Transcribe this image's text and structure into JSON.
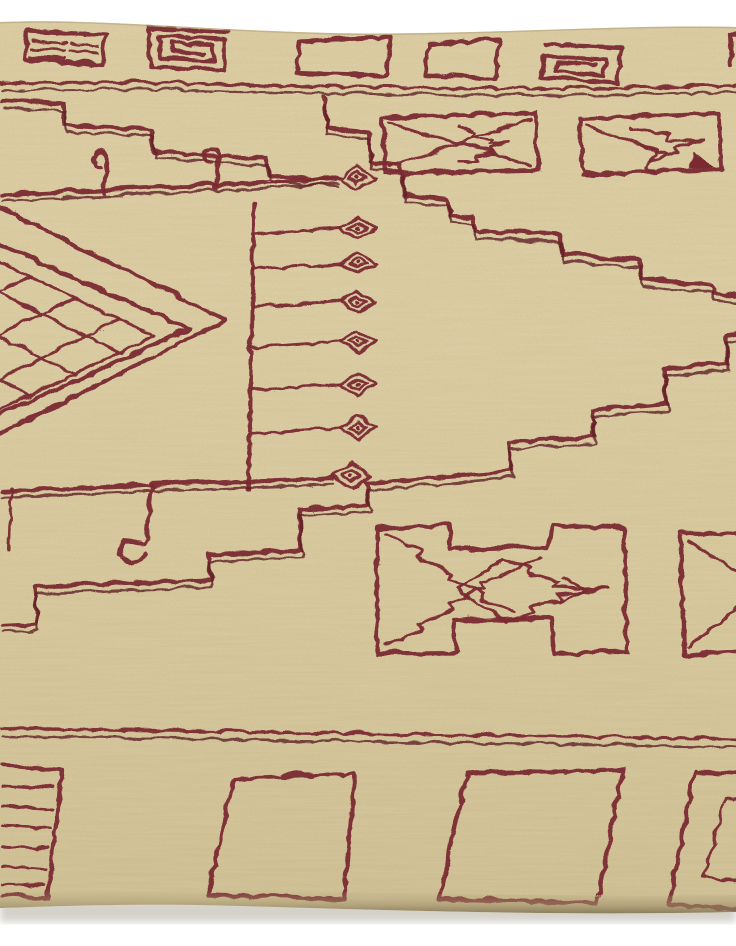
{
  "scene": {
    "description": "Angled close-up photograph of a cream hand-knotted wool rug decorated with dark maroon geometric Berber-style motifs, displayed against a plain white backdrop visible above the top edge and below the bottom edge of the rug.",
    "object": "moroccan-style-area-rug",
    "view": "rug fills the frame edge-to-edge horizontally; slightly wavy top and bottom selvedge edges with pile shadow along the bottom"
  },
  "palette": {
    "backdrop": "#ffffff",
    "field": "#d9c99b",
    "field_light": "#e6d7ad",
    "field_dark": "#cdbd90",
    "pattern": "#7b2a33",
    "pattern_dark": "#5f1f26",
    "edge_shadow": "#968a66",
    "cast_shadow": "#c9c6bd"
  },
  "motifs": {
    "top_border": [
      "striped-key-square",
      "spiral-key-square",
      "open-square",
      "open-square",
      "spiral-key-square",
      "partial-square-at-edge"
    ],
    "upper_field": [
      "stepped-zigzag-line",
      "baseline-with-two-crook-hooks",
      "arrow-box-with-crossed-diagonals",
      "arrow-box-with-solid-corner-triangle"
    ],
    "center": [
      "comb-spine-with-lozenge-tipped-teeth",
      "gridded-diamond-medallion",
      "stepped-medallion-outline-upper",
      "stepped-medallion-outline-lower",
      "pendant-hook-drops"
    ],
    "lower_field": [
      "bowtie-arrow-motif",
      "partial-bowtie-arrow-motif"
    ],
    "bottom_border": [
      "striped-square",
      "open-square",
      "open-square",
      "nested-square-partial"
    ]
  },
  "counts": {
    "comb_teeth": 8,
    "top_border_squares": 6,
    "bottom_border_squares": 4,
    "arrow_boxes": 2,
    "bowtie_motifs": 2
  }
}
